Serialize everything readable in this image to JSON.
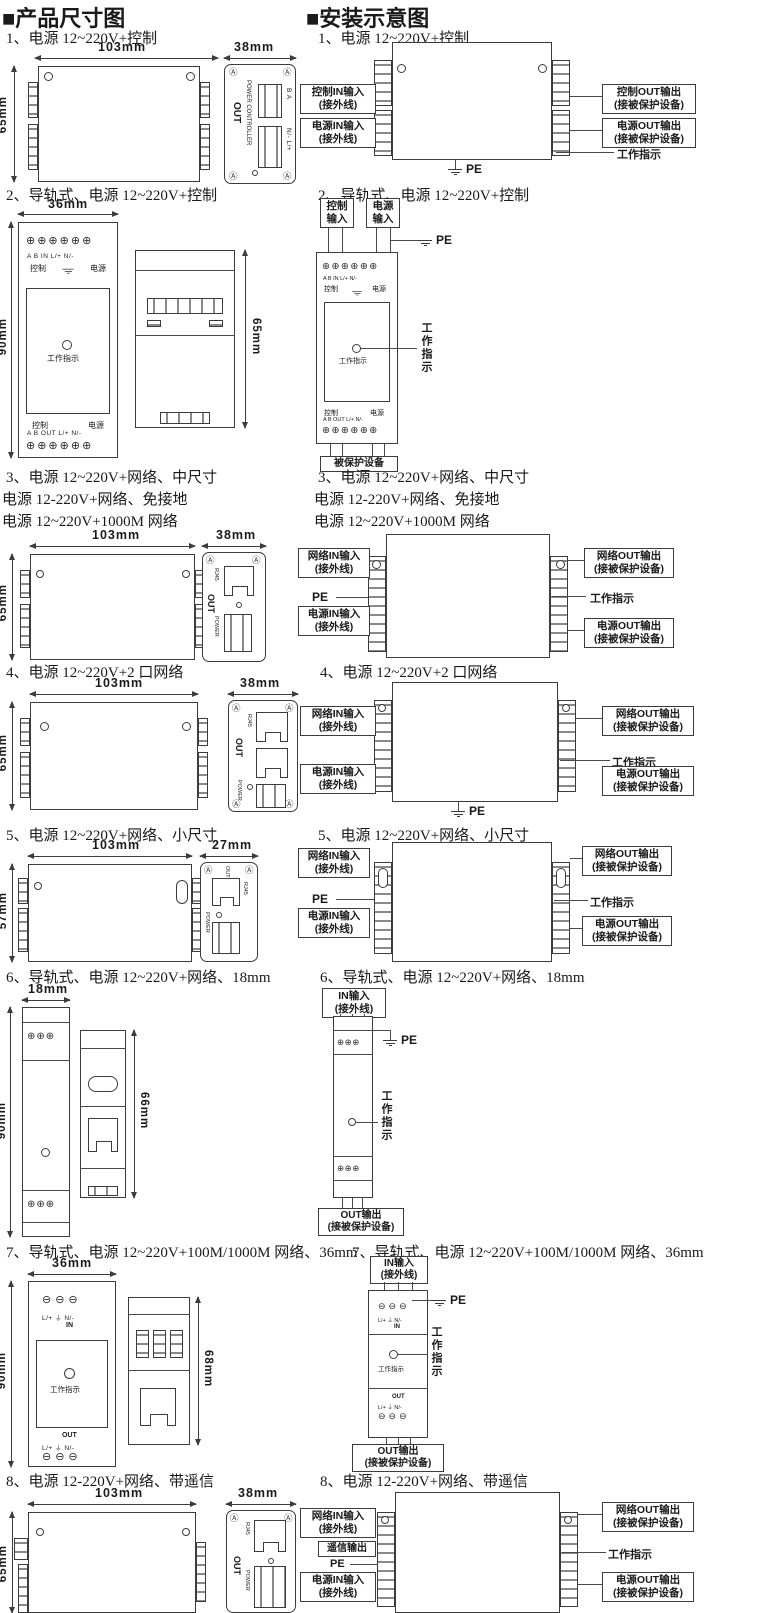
{
  "page": {
    "left_header": "■产品尺寸图",
    "right_header": "■安装示意图"
  },
  "icons": {
    "corner_screw": "Ⓐ",
    "screws6": "⊕⊕⊕⊕⊕⊕",
    "screws3": "⊕⊕⊕",
    "screws3_slot": "⊖⊖⊖"
  },
  "labels": {
    "pe": "PE",
    "work": "工作指示",
    "out": "OUT",
    "in": "IN",
    "power": "POWER",
    "rj45": "RJ45",
    "power_controller": "POWER CONTROLLER",
    "ctrl": "控制",
    "pwr": "电源",
    "s1_top_block": "B A",
    "s1_bot_block": "N/- L/+",
    "din_top_row": "A  B   IN   L/+ N/-",
    "din_bot_row": "A  B  OUT  L/+ N/-",
    "lpn": "L/+  ⏚  N/-"
  },
  "callouts": {
    "ctrl_in": [
      "控制IN输入",
      "(接外线)"
    ],
    "pwr_in": [
      "电源IN输入",
      "(接外线)"
    ],
    "net_in": [
      "网络IN输入",
      "(接外线)"
    ],
    "in_in": [
      "IN输入",
      "(接外线)"
    ],
    "ctrl_out": [
      "控制OUT输出",
      "(接被保护设备)"
    ],
    "pwr_out": [
      "电源OUT输出",
      "(接被保护设备)"
    ],
    "net_out": [
      "网络OUT输出",
      "(接被保护设备)"
    ],
    "out_out": [
      "OUT输出",
      "(接被保护设备)"
    ],
    "ctrl_input": "控制输入",
    "pwr_input": "电源输入",
    "protected_dev": "被保护设备",
    "telemetry_out": "遥信输出"
  },
  "sections": {
    "s1": {
      "title": "1、电源 12~220V+控制",
      "dim_w": "103mm",
      "dim_s": "38mm",
      "dim_h": "65mm"
    },
    "s2": {
      "title": "2、导轨式、电源 12~220V+控制",
      "dim_w": "36mm",
      "dim_h": "90mm",
      "dim_s": "65mm"
    },
    "s3": {
      "title": "3、电源 12~220V+网络、中尺寸",
      "title2": "电源 12-220V+网络、免接地",
      "title3": "电源 12~220V+1000M 网络",
      "dim_w": "103mm",
      "dim_s": "38mm",
      "dim_h": "65mm"
    },
    "s4": {
      "title": "4、电源 12~220V+2 口网络",
      "dim_w": "103mm",
      "dim_s": "38mm",
      "dim_h": "65mm"
    },
    "s5": {
      "title": "5、电源 12~220V+网络、小尺寸",
      "dim_w": "103mm",
      "dim_s": "27mm",
      "dim_h": "57mm"
    },
    "s6": {
      "title": "6、导轨式、电源 12~220V+网络、18mm",
      "dim_w": "18mm",
      "dim_h": "90mm",
      "dim_s": "66mm"
    },
    "s7": {
      "title": "7、导轨式、电源 12~220V+100M/1000M 网络、36mm",
      "dim_w": "36mm",
      "dim_h": "90mm",
      "dim_s": "68mm"
    },
    "s8": {
      "title": "8、电源 12-220V+网络、带遥信",
      "dim_w": "103mm",
      "dim_s": "38mm",
      "dim_h": "65mm"
    }
  }
}
